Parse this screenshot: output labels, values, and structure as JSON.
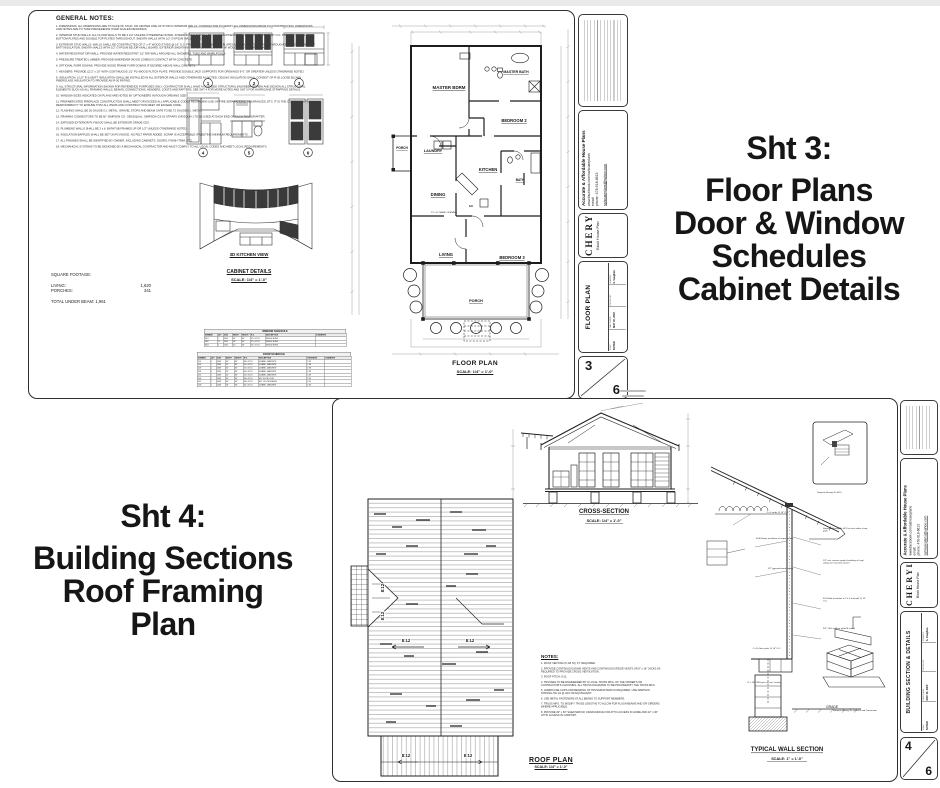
{
  "page": {
    "bg": "#ffffff",
    "topbar_color": "#e9e9e9"
  },
  "headlines": {
    "sheet3": {
      "intro": "Sht 3:",
      "lines": [
        "Floor Plans",
        "Door & Window",
        "Schedules",
        "Cabinet Details"
      ]
    },
    "sheet4": {
      "intro": "Sht 4:",
      "lines": [
        "Building Sections",
        "Roof Framing",
        "Plan"
      ]
    }
  },
  "titleblock": {
    "company": {
      "name": "Accurate & Affordable House Plans",
      "facebook": "www.facebook.com/sahouseplans",
      "email_label": "email:",
      "phone": "phone: 478-918-6613",
      "email": "sahouseplans@yahoo.com"
    },
    "client_name": "CHERYL",
    "plan_name": "Block House Plan",
    "fields": {
      "scale_label": "SCALE:",
      "scale_value": "NOTED",
      "date_label": "DATE DRAWN:",
      "date_value": "MAY 26, 2006",
      "checked_label": "CHECKED BY:",
      "checked_value": "",
      "drawn_label": "DRAWN BY:",
      "drawn_value": "S. Vaughan"
    },
    "sheet3_title": "FLOOR PLAN",
    "sheet4_title": "BUILDING SECTION & DETAILS",
    "sheet3_number": "3",
    "sheet4_number": "4",
    "sheet_total": "6"
  },
  "sheet3": {
    "general_notes": {
      "heading": "GENERAL NOTES:",
      "items": [
        "1.  DIMENSIONS:  ALL DIMENSIONS ARE TO FACE OF STUD, OR CENTER LINE OF STUD IN INTERIOR WALLS.  CONTRACTOR TO VERIFY ALL DIMENSIONS PRIOR TO CONSTRUCTION.  DIMENSIONS AND NOTES ARE TO TAKE PRECEDENCE OVER SCALED DRAWINGS.",
        "2.  INTERIOR STUD WALLS:  ALL FLOOR WALLS TO BE 3 1/2\" UNLESS OTHERWISE NOTED.  INTERIOR WALLS SHALL BE CONSTRUCTED OF 2\" x 4\" WOOD STUDS @ 16\" O.C.  PROVIDE SINGLE BOTTOM PLATES AND DOUBLE TOP PLATES THROUGHOUT.  SHEATH WALLS WITH 1/2\" GYPSUM WALLBOARD.",
        "3.  EXTERIOR STUD WALLS:  WALLS SHALL BE CONSTRUCTED OF 2\" x 4\" WOOD STUDS @ 16\" O.C.  PROVIDE SINGLE BOTTOM PLATES AND DOUBLE TOP PLATES THROUGHOUT.  PROVIDE R-13 1/2\" BATT INSULATION.  SHEATH WALLS WITH 1/2\" GYPSUM BD./DRYWALL BOARD.  EXTERIOR SHEATHING SHALL BE VINYL SIDING W/ WOOD STUDS OVER PLYWOOD.",
        "4.  WATER RESISTANT DRYWALL:  PROVIDE WATER RESISTANT 1/2\" DRYWALL AROUND ALL SHOWERS, TUBS AND WHIRLPOOLS.",
        "5.  PRESSURE TREATED LUMBER:  PROVIDE WHEREVER WOOD COMES IN CONTACT WITH CONCRETE.",
        "6.  OPTIONAL FURR DOWNS:  PROVIDE WOOD FRAME FURR DOWNS IF DESIRED ABOVE WALL CABINETS.",
        "7.  HEADERS:  PROVIDE (2) 2\" x 10\" WITH CONTINUOUS 1/2\" PLYWOOD FLITCH PLATE.  PROVIDE DOUBLE JACK SUPPORTS FOR OPENINGS 6'-0\" OR GREATER UNLESS OTHERWISE NOTED.",
        "8.  INSULATION:  3 1/2\" R-13 BATT INSULATION SHALL BE INSTALLED IN ALL EXTERIOR WALLS AND OTHERWISE AS NOTED.  CEILING INSULATION SHALL CONSIST OF R-30 LOOSE BLOWN FIBERGLASS INSULATION TO PROVIDE AN R-30 RATING.",
        "9.  ALL STRUCTURAL INFORMATION SHOWN FOR REFERENCE PURPOSES ONLY.  CONTRACTOR SHALL HAVE A LICENSED STRUCTURAL ENGINEER REVIEW AND DESIGN ALL STRUCTURAL ELEMENTS SUCH AS ALL FRAMING WALLS, BEAMS, CONNECTIONS, HEADERS, JOISTS AND RAFTERS.  SEE SHT 4 FOR MORE NOTES AND SHT 5 FOR HURRICANE STRAPPING DETAILS.",
        "10.  WINDOW SIZES INDICATED ON PLANS ARE NOTED BY OPTIONEERS IN ROUGH OPENING SIZES.",
        "11.  PREFABRICATED FIREPLACE CONSTRUCTION SHALL MEET OR EXCEED ALL APPLICABLE CODES REGARDING USE OF FIRE SEPARATIONS, CLEARANCES, ETC.  IT IS THE CONTRACTOR'S RESPONSIBILITY TO ENSURE THAT ALL ITEMS AND CONSTRUCTION MEET OR EXCEED CODE.",
        "12.  FLASHING SHALL BE 26 GAUGE G.I. METAL.  GRAVEL STOPS AND BEAM CAPS TO BE 72 GAUGE G.I. METAL.",
        "13.  FRAMING CONNECTORS TO BE BY SIMPSON CO. O[R] EQUAL.  SIMPSON CS-16 STRAPS (OR EQUIV.) TO BE USED AT EACH END OF EACH TRUSS/RAFTER.",
        "14.  EXPOSED EXTERIOR PLYWOOD SHALL BE EXTERIOR GRADE CDX.",
        "15.  PLUMBING WALLS SHALL BE 2 x 6.  BATHTUB FRAMES UP OR 1/2\" UNLESS OTHERWISE NOTED.",
        "16.  INSULATION BAFFLES SHALL BE SET ON PLYWOOD, NO FELT PAPER ADDED.  SCRAP IS ACCEPTABLE IF MEETING MINIMUM REQUIREMENTS.",
        "17.  ALL FINISHES SHALL BE IDENTIFIED BY OWNER, INCLUDING CABINETS, DOORS, FINISH TRIM, ETC.",
        "18.  MECHANICAL SYSTEMS TO BE DESIGNED BY A MECHANICAL CONTRACTOR AND MUST COMPLY TO ALL LOCAL CODES AND MEET LOCAL REQUIREMENTS."
      ]
    },
    "square_footage": {
      "heading": "SQUARE FOOTAGE:",
      "rows": [
        [
          "LIVING:",
          "1,620"
        ],
        [
          "PORCHES:",
          "341"
        ]
      ],
      "total_label": "TOTAL UNDER BEAM:",
      "total_value": "1,961"
    },
    "cabinet_labels": {
      "kitchen_view": "3D KITCHEN VIEW",
      "title": "CABINET DETAILS",
      "scale": "SCALE:  1/4\" = 1'-0\""
    },
    "elevation_numbers": [
      "1",
      "2",
      "3",
      "4",
      "5",
      "6"
    ],
    "window_schedule": {
      "title": "WINDOW SCHEDULE",
      "headers": [
        "NUMBER",
        "QTY",
        "SIZE",
        "WIDTH",
        "HEIGHT",
        "R.O.",
        "DESCRIPTION",
        "COMMENTS"
      ],
      "rows": [
        [
          "W01",
          "1",
          "3050",
          "36\"",
          "60\"",
          "37 x 61 1/2",
          "SINGLE HUNG",
          ""
        ],
        [
          "W02",
          "11",
          "3050",
          "36\"",
          "60\"",
          "37 x 61 1/2",
          "SINGLE HUNG",
          ""
        ],
        [
          "W03",
          "1",
          "2030",
          "24\"",
          "36\"",
          "25 x 37 1/2",
          "SINGLE HUNG",
          ""
        ]
      ]
    },
    "door_schedule": {
      "title": "DOOR SCHEDULE",
      "headers": [
        "NUMBER",
        "QTY",
        "SIZE",
        "WIDTH",
        "HEIGHT",
        "R.O.",
        "DESCRIPTION",
        "THICKNESS",
        "COMMENTS"
      ],
      "rows": [
        [
          "D01",
          "1",
          "3068",
          "36\"",
          "80\"",
          "38 x 82 1/2",
          "4-PANEL, MASONITE",
          "1 3/8",
          ""
        ],
        [
          "D02",
          "1",
          "2868",
          "32\"",
          "80\"",
          "34 x 82 1/2",
          "4-PANEL, MASONITE",
          "1 3/8",
          ""
        ],
        [
          "D03",
          "1",
          "2668",
          "30\"",
          "80\"",
          "32 x 82 1/2",
          "4-PANEL, MASONITE",
          "1 3/8",
          ""
        ],
        [
          "D04",
          "4",
          "2468",
          "28\"",
          "80\"",
          "30 x 82 1/2",
          "4-PANEL, MASONITE",
          "1 3/8",
          ""
        ],
        [
          "D05",
          "1",
          "2068",
          "24\"",
          "80\"",
          "26 x 82 1/2",
          "4-PANEL, MASONITE",
          "1 3/8",
          ""
        ],
        [
          "D06",
          "1",
          "3068",
          "36\"",
          "80\"",
          "38 x 82 1/2",
          "EXT 6-LITE DOOR",
          "1 3/4",
          ""
        ],
        [
          "D07",
          "1",
          "3068",
          "36\"",
          "80\"",
          "38 x 82 1/2",
          "EXT 15-LITE FRENCH",
          "1 3/4",
          ""
        ],
        [
          "D08",
          "1",
          "2468",
          "28\"",
          "80\"",
          "30 x 82 1/2",
          "4-PANEL, MASONITE",
          "1 3/8",
          ""
        ]
      ]
    },
    "floor_plan": {
      "title": "FLOOR PLAN",
      "scale": "SCALE:  1/4\" = 1'-0\"",
      "rooms": {
        "master": "MASTER BDRM",
        "master_bath": "MASTER BATH",
        "bed2": "BEDROOM 2",
        "porch_side": "PORCH",
        "laundry": "LAUNDRY",
        "kitchen": "KITCHEN",
        "dining": "DINING",
        "bath": "BATH",
        "living": "LIVING",
        "bed3": "BEDROOM 3",
        "porch_front": "PORCH"
      },
      "ac_label": "A/C",
      "cased_opening": "12' x 8' CASED OPENING"
    }
  },
  "sheet4": {
    "cross_section": {
      "title": "CROSS-SECTION",
      "scale": "SCALE:  1/4\" = 1'-0\""
    },
    "roof_plan": {
      "title": "ROOF PLAN",
      "scale": "SCALE: 1/4\" = 1'-0\"",
      "slope": "8:12"
    },
    "notes": {
      "heading": "NOTES:",
      "items": [
        "1.  ROOF VENTING IS 1/8 SQ. FT. REQUIRED.",
        "2.  PROVIDE CONTINUOUS EAVE VENTS AND CONTINUOUS RIDGE VENTS OR 8\" x 16\" JACKS AS REQUIRED TO PROVIDE CROSS VENTILATION.",
        "3.  ROOF PITCH:  8:12.",
        "4.  TRUSSES TO BE ENGINEERED BY A LOCAL TRUSS MFG. OF THE OWNER'S OR CONTRACTOR'S CHOOSING.  ALL TRUSS DIAGRAMS TO BE PROVIDED BY THE TRUSS MFG.",
        "5.  HURRICANE CLIPS AND BEARING OF TRUSS/RAFTERS IS REQUIRED.  USE SIMPSON STRONG-TIE H1 @ H10 OR EQUIVALENT.",
        "6.  USE METAL FASTENERS AT ALL BEAMS TO SUPPORT MEMBERS.",
        "7.  TRUSS MFG. TO MODIFY TRUSS LENGTHS TO ALLOW FOR FLUSH BEAMS AND OR GIRDERS WHERE APPLICABLE.",
        "8.  PROVIDE 30\" x 60\" SHEATHROCK CRAWLSPACE FOR ATTIC ACCESS IN HOME AND 22\" x 30\" ATTIC ACCESS IN CARPORT."
      ]
    },
    "wall_section": {
      "title": "TYPICAL WALL SECTION",
      "scale": "SCALE:  1\" = 1'-0\"",
      "grade": "GRADE",
      "inset_caption": "Simpson Strong-Tie H2.5",
      "masonry_caption": "Simpson Strong-Tie Lateral Load Connection",
      "callouts_right": [
        "Simpson Strong-Tie H2.5 at each rafter to top plate",
        "1/2\" min. exterior grade sheathing w/ vinyl siding over moisture barrier",
        "R-13 Batt Insulation in 2 x 4 stud wall @ 16\" O.C.",
        "3/4\" T&G subfloor glued & nailed"
      ],
      "callouts_left": [
        "R-30 blown insulation w/ vapor barrier",
        "1/2\" gypsum board ceiling",
        "2 x 4 studs @ 16\" O.C."
      ],
      "callouts_bottom": [
        "2 x 10 floor joists @ 16\" O.C.",
        "8\" x 16\" CMU pier on conc. footing"
      ]
    }
  }
}
